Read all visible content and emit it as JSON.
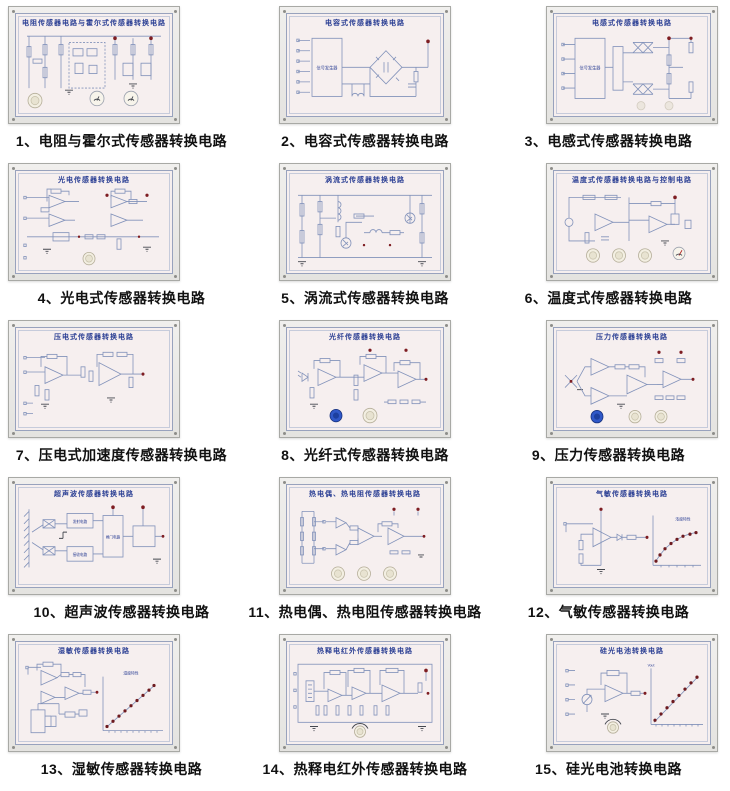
{
  "page": {
    "background": "#ffffff"
  },
  "colors": {
    "panel_face": "#f6efef",
    "panel_frame": "#e9e8e5",
    "circuit_line": "#8292ba",
    "panel_title_text": "#2b3f94",
    "caption_text": "#111111",
    "terminal_red": "#7e1d22",
    "graph_dot": "#6d1a1f",
    "knob_white": "#f3efe2",
    "knob_blue": "#3058c8"
  },
  "panels": [
    {
      "num": "1",
      "title": "电阻传感器电路与霍尔式传感器转换电路",
      "caption": "1、电阻与霍尔式传感器转换电路"
    },
    {
      "num": "2",
      "title": "电容式传感器转换电路",
      "caption": "2、电容式传感器转换电路",
      "inner_label": "信号发生器"
    },
    {
      "num": "3",
      "title": "电感式传感器转换电路",
      "caption": "3、电感式传感器转换电路",
      "inner_label": "信号发生器"
    },
    {
      "num": "4",
      "title": "光电传感器转换电路",
      "caption": "4、光电式传感器转换电路"
    },
    {
      "num": "5",
      "title": "涡流式传感器转换电路",
      "caption": "5、涡流式传感器转换电路"
    },
    {
      "num": "6",
      "title": "温度式传感器转换电路与控制电路",
      "caption": "6、温度式传感器转换电路"
    },
    {
      "num": "7",
      "title": "压电式传感器转换电路",
      "caption": "7、压电式加速度传感器转换电路"
    },
    {
      "num": "8",
      "title": "光纤传感器转换电路",
      "caption": "8、光纤式传感器转换电路"
    },
    {
      "num": "9",
      "title": "压力传感器转换电路",
      "caption": "9、压力传感器转换电路"
    },
    {
      "num": "10",
      "title": "超声波传感器转换电路",
      "caption": "10、超声波传感器转换电路",
      "blocks": [
        "发射电路",
        "接收电路",
        "闸门电路"
      ]
    },
    {
      "num": "11",
      "title": "热电偶、热电阻传感器转换电路",
      "caption": "11、热电偶、热电阻传感器转换电路"
    },
    {
      "num": "12",
      "title": "气敏传感器转换电路",
      "caption": "12、气敏传感器转换电路",
      "graph_label": "浓度特性"
    },
    {
      "num": "13",
      "title": "湿敏传感器转换电路",
      "caption": "13、湿敏传感器转换电路",
      "graph_label": "湿度特性"
    },
    {
      "num": "14",
      "title": "热释电红外传感器转换电路",
      "caption": "14、热释电红外传感器转换电路"
    },
    {
      "num": "15",
      "title": "硅光电池转换电路",
      "caption": "15、硅光电池转换电路",
      "graph_label": "Vout"
    }
  ]
}
